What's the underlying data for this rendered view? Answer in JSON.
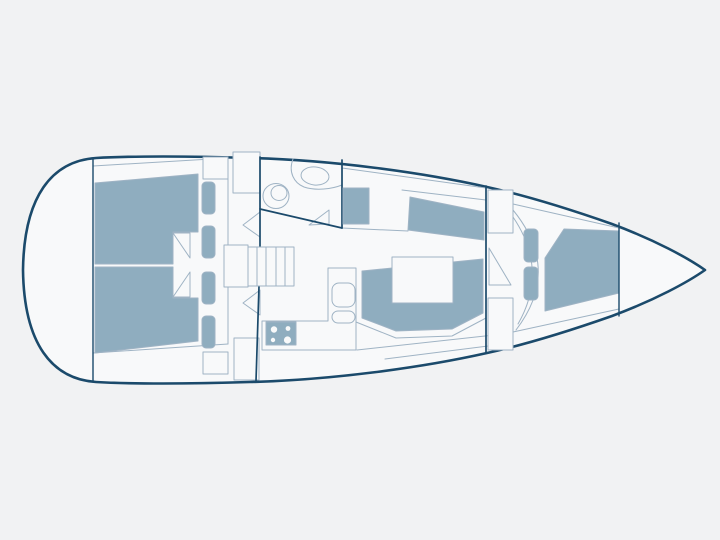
{
  "palette": {
    "bg": "#f1f2f3",
    "hullFill": "#f8f9fa",
    "navy": "#1b4a6b",
    "line": "#9fb3c4",
    "berth": "#8fadbf",
    "white": "#f8f9fa"
  },
  "canvas": {
    "width": 720,
    "height": 540
  },
  "diagram": {
    "kind": "sailboat-interior-floorplan",
    "shapes": [
      {
        "name": "hull-outline",
        "kind": "path",
        "d": "M705,270 C688,258 655,240 612,224 C575,211 528,196 487,187 C420,172 330,160 250,158 C190,156 130,156 96,158 C52,161 24,196 23,270 C24,344 52,379 96,382 C130,384 190,384 250,382 C330,380 420,368 487,353 C528,344 575,329 612,316 C655,300 688,282 705,270 Z",
        "fill": "$hullFill",
        "stroke": "$navy",
        "sw": 2.6
      },
      {
        "name": "side-deck-line-top-aft",
        "kind": "line",
        "x1": 93,
        "y1": 166,
        "x2": 228,
        "y2": 158,
        "stroke": "$line",
        "sw": 1
      },
      {
        "name": "side-deck-line-bottom-aft",
        "kind": "line",
        "x1": 93,
        "y1": 353,
        "x2": 228,
        "y2": 344,
        "stroke": "$line",
        "sw": 1
      },
      {
        "name": "side-deck-line-top-mid",
        "kind": "line",
        "x1": 342,
        "y1": 168,
        "x2": 486,
        "y2": 188,
        "stroke": "$line",
        "sw": 1
      },
      {
        "name": "settee-back-line",
        "kind": "line",
        "x1": 402,
        "y1": 190,
        "x2": 486,
        "y2": 200,
        "stroke": "$line",
        "sw": 1
      },
      {
        "name": "side-deck-line-top-fwd",
        "kind": "line",
        "x1": 513,
        "y1": 204,
        "x2": 619,
        "y2": 228,
        "stroke": "$line",
        "sw": 1
      },
      {
        "name": "side-deck-line-bottom-fwd",
        "kind": "line",
        "x1": 513,
        "y1": 332,
        "x2": 619,
        "y2": 309,
        "stroke": "$line",
        "sw": 1
      },
      {
        "name": "cockpit-taper-line-1",
        "kind": "line",
        "x1": 357,
        "y1": 350,
        "x2": 512,
        "y2": 333,
        "stroke": "$line",
        "sw": 1
      },
      {
        "name": "cockpit-taper-line-2",
        "kind": "line",
        "x1": 385,
        "y1": 359,
        "x2": 512,
        "y2": 343,
        "stroke": "$line",
        "sw": 1
      },
      {
        "name": "nav-area-base-line",
        "kind": "line",
        "x1": 342,
        "y1": 228,
        "x2": 408,
        "y2": 231,
        "stroke": "$line",
        "sw": 1
      },
      {
        "name": "aft-cabin-top-berth",
        "kind": "polygon",
        "points": "95,183 198,174 198,232 173,232 173,264 95,264",
        "fill": "$berth",
        "stroke": "$line",
        "sw": 1
      },
      {
        "name": "aft-cabin-top-door-leaf",
        "kind": "polygon",
        "points": "173,233 190,233 190,258",
        "fill": "$white",
        "stroke": "$line",
        "sw": 1
      },
      {
        "name": "aft-cabin-top-pillow-1",
        "kind": "rect",
        "x": 202,
        "y": 182,
        "w": 13,
        "h": 32,
        "rx": 4,
        "fill": "$berth",
        "stroke": "$line",
        "sw": 1
      },
      {
        "name": "aft-cabin-top-pillow-2",
        "kind": "rect",
        "x": 202,
        "y": 226,
        "w": 13,
        "h": 32,
        "rx": 4,
        "fill": "$berth",
        "stroke": "$line",
        "sw": 1
      },
      {
        "name": "aft-cabin-top-wall",
        "kind": "line",
        "x1": 228,
        "y1": 157,
        "x2": 228,
        "y2": 264,
        "stroke": "$line",
        "sw": 1
      },
      {
        "name": "aft-cabin-top-shelf",
        "kind": "rect",
        "x": 203,
        "y": 157,
        "w": 25,
        "h": 22,
        "rx": 0,
        "fill": "$white",
        "stroke": "$line",
        "sw": 1
      },
      {
        "name": "aft-cabin-bottom-berth",
        "kind": "polygon",
        "points": "95,267 173,267 173,298 198,298 198,341 95,353",
        "fill": "$berth",
        "stroke": "$line",
        "sw": 1
      },
      {
        "name": "aft-cabin-bottom-door-leaf",
        "kind": "polygon",
        "points": "173,297 190,297 190,272",
        "fill": "$white",
        "stroke": "$line",
        "sw": 1
      },
      {
        "name": "aft-cabin-bottom-pillow-1",
        "kind": "rect",
        "x": 202,
        "y": 272,
        "w": 13,
        "h": 32,
        "rx": 4,
        "fill": "$berth",
        "stroke": "$line",
        "sw": 1
      },
      {
        "name": "aft-cabin-bottom-pillow-2",
        "kind": "rect",
        "x": 202,
        "y": 316,
        "w": 13,
        "h": 32,
        "rx": 4,
        "fill": "$berth",
        "stroke": "$line",
        "sw": 1
      },
      {
        "name": "aft-cabin-bottom-wall",
        "kind": "line",
        "x1": 228,
        "y1": 267,
        "x2": 228,
        "y2": 344,
        "stroke": "$line",
        "sw": 1
      },
      {
        "name": "aft-cabin-bottom-shelf",
        "kind": "rect",
        "x": 203,
        "y": 352,
        "w": 25,
        "h": 22,
        "rx": 0,
        "fill": "$white",
        "stroke": "$line",
        "sw": 1
      },
      {
        "name": "top-locker",
        "kind": "rect",
        "x": 233,
        "y": 152,
        "w": 27,
        "h": 41,
        "rx": 0,
        "fill": "$white",
        "stroke": "$line",
        "sw": 1
      },
      {
        "name": "bottom-locker",
        "kind": "rect",
        "x": 234,
        "y": 338,
        "w": 25,
        "h": 42,
        "rx": 0,
        "fill": "$white",
        "stroke": "$line",
        "sw": 1
      },
      {
        "name": "engine-box",
        "kind": "rect",
        "x": 224,
        "y": 245,
        "w": 24,
        "h": 42,
        "rx": 0,
        "fill": "$white",
        "stroke": "$line",
        "sw": 1
      },
      {
        "name": "aft-cabin-top-door-swing",
        "kind": "polygon",
        "points": "260,212 260,237 243,225",
        "fill": "$white",
        "stroke": "$line",
        "sw": 1
      },
      {
        "name": "aft-cabin-bottom-door-swing",
        "kind": "polygon",
        "points": "260,290 260,315 243,303",
        "fill": "$white",
        "stroke": "$line",
        "sw": 1
      },
      {
        "name": "head-vanity-counter",
        "kind": "path",
        "d": "M293,159 C288,172 294,183 304,187 C316,191 332,189 342,185",
        "fill": "none",
        "stroke": "$line",
        "sw": 1
      },
      {
        "name": "head-sink",
        "kind": "ellipse",
        "cx": 315,
        "cy": 176,
        "rx": 14,
        "ry": 9,
        "rotate": 6,
        "fill": "$white",
        "stroke": "$line",
        "sw": 1
      },
      {
        "name": "head-toilet-outer",
        "kind": "ellipse",
        "cx": 276,
        "cy": 196,
        "rx": 13,
        "ry": 12.5,
        "rotate": 0,
        "fill": "$white",
        "stroke": "$line",
        "sw": 1
      },
      {
        "name": "head-toilet-inner",
        "kind": "ellipse",
        "cx": 279,
        "cy": 193,
        "rx": 8,
        "ry": 7.5,
        "rotate": 0,
        "fill": "$white",
        "stroke": "$line",
        "sw": 1
      },
      {
        "name": "head-door-leaf",
        "kind": "polygon",
        "points": "309,225 329,210 329,224",
        "fill": "$white",
        "stroke": "$line",
        "sw": 1
      },
      {
        "name": "main-bulkhead-upper",
        "kind": "line",
        "x1": 260,
        "y1": 157,
        "x2": 260,
        "y2": 247,
        "stroke": "$navy",
        "sw": 1.7
      },
      {
        "name": "main-bulkhead-lower",
        "kind": "line",
        "x1": 259,
        "y1": 286,
        "x2": 256,
        "y2": 381,
        "stroke": "$navy",
        "sw": 1.7
      },
      {
        "name": "head-wall-fwd",
        "kind": "line",
        "x1": 342,
        "y1": 160,
        "x2": 342,
        "y2": 228,
        "stroke": "$navy",
        "sw": 1.7
      },
      {
        "name": "head-wall-diagonal",
        "kind": "line",
        "x1": 260,
        "y1": 209,
        "x2": 342,
        "y2": 228,
        "stroke": "$navy",
        "sw": 1.7
      },
      {
        "name": "transom-bulkhead-wall",
        "kind": "line",
        "x1": 93,
        "y1": 159,
        "x2": 93,
        "y2": 382,
        "stroke": "$navy",
        "sw": 1.4
      },
      {
        "name": "companionway-steps",
        "kind": "rect",
        "x": 248,
        "y": 247,
        "w": 46,
        "h": 39,
        "rx": 0,
        "fill": "$white",
        "stroke": "$line",
        "sw": 1
      },
      {
        "name": "companionway-step-treads",
        "kind": "path",
        "d": "M257,247 L257,286 M266,247 L266,286 M276,247 L276,286 M285,247 L285,286",
        "fill": "none",
        "stroke": "$line",
        "sw": 1
      },
      {
        "name": "galley-counter",
        "kind": "path",
        "d": "M262,350 L262,321 L328,321 L328,268 L356,268 L356,350 Z",
        "fill": "$white",
        "stroke": "$line",
        "sw": 1
      },
      {
        "name": "galley-stove",
        "kind": "rect",
        "x": 266,
        "y": 322,
        "w": 30,
        "h": 23,
        "rx": 0,
        "fill": "$berth",
        "stroke": "$line",
        "sw": 1
      },
      {
        "name": "stove-burner-1",
        "kind": "circle",
        "cx": 274,
        "cy": 329.5,
        "r": 3.2,
        "fill": "$white",
        "stroke": "none",
        "sw": 0
      },
      {
        "name": "stove-burner-2",
        "kind": "circle",
        "cx": 288,
        "cy": 328.5,
        "r": 2.4,
        "fill": "$white",
        "stroke": "none",
        "sw": 0
      },
      {
        "name": "stove-burner-3",
        "kind": "circle",
        "cx": 273,
        "cy": 340,
        "r": 2.2,
        "fill": "$white",
        "stroke": "none",
        "sw": 0
      },
      {
        "name": "stove-burner-4",
        "kind": "circle",
        "cx": 287.5,
        "cy": 340,
        "r": 3.6,
        "fill": "$white",
        "stroke": "none",
        "sw": 0
      },
      {
        "name": "galley-sink",
        "kind": "rect",
        "x": 332,
        "y": 283,
        "w": 23,
        "h": 24,
        "rx": 7,
        "fill": "$white",
        "stroke": "$line",
        "sw": 1
      },
      {
        "name": "galley-sink-drainer",
        "kind": "rect",
        "x": 332,
        "y": 311,
        "w": 23,
        "h": 12,
        "rx": 6,
        "fill": "$white",
        "stroke": "$line",
        "sw": 1
      },
      {
        "name": "nav-seat",
        "kind": "rect",
        "x": 343,
        "y": 188,
        "w": 26,
        "h": 36,
        "rx": 0,
        "fill": "$berth",
        "stroke": "$line",
        "sw": 1
      },
      {
        "name": "salon-settee-top",
        "kind": "polygon",
        "points": "410,197 484,212 484,240 408,230",
        "fill": "$berth",
        "stroke": "$line",
        "sw": 1
      },
      {
        "name": "salon-settee-u",
        "kind": "polygon",
        "points": "362,271 453,262 483,259 483,313 452,329 396,331 362,318",
        "fill": "$berth",
        "stroke": "$line",
        "sw": 1
      },
      {
        "name": "salon-settee-trim",
        "kind": "polyline",
        "points": "356,322 396,338 452,336 486,318",
        "fill": "none",
        "stroke": "$line",
        "sw": 1
      },
      {
        "name": "salon-table",
        "kind": "rect",
        "x": 392,
        "y": 257,
        "w": 61,
        "h": 46,
        "rx": 0,
        "fill": "$white",
        "stroke": "$line",
        "sw": 1
      },
      {
        "name": "fwd-bulkhead",
        "kind": "line",
        "x1": 486,
        "y1": 186,
        "x2": 486,
        "y2": 352,
        "stroke": "$navy",
        "sw": 1.7
      },
      {
        "name": "fwd-door-swing-arc-outer",
        "kind": "path",
        "d": "M513,210 Q562,270 516,330",
        "fill": "none",
        "stroke": "$line",
        "sw": 1
      },
      {
        "name": "fwd-door-swing-arc-inner",
        "kind": "path",
        "d": "M513,217 Q549,270 518,324",
        "fill": "none",
        "stroke": "$line",
        "sw": 1
      },
      {
        "name": "fwd-door-leaf",
        "kind": "polygon",
        "points": "489,248 489,285 511,285",
        "fill": "$white",
        "stroke": "$line",
        "sw": 1
      },
      {
        "name": "fwd-locker-top",
        "kind": "rect",
        "x": 488,
        "y": 190,
        "w": 25,
        "h": 43,
        "rx": 0,
        "fill": "$white",
        "stroke": "$line",
        "sw": 1
      },
      {
        "name": "fwd-locker-bottom",
        "kind": "rect",
        "x": 488,
        "y": 298,
        "w": 25,
        "h": 52,
        "rx": 0,
        "fill": "$white",
        "stroke": "$line",
        "sw": 1
      },
      {
        "name": "vberth",
        "kind": "polygon",
        "points": "545,258 564,229 619,231 619,293 545,311",
        "fill": "$berth",
        "stroke": "$line",
        "sw": 1
      },
      {
        "name": "vberth-cushion-1",
        "kind": "rect",
        "x": 524,
        "y": 229,
        "w": 14,
        "h": 33,
        "rx": 4,
        "fill": "$berth",
        "stroke": "$line",
        "sw": 1
      },
      {
        "name": "vberth-cushion-2",
        "kind": "rect",
        "x": 524,
        "y": 267,
        "w": 14,
        "h": 33,
        "rx": 4,
        "fill": "$berth",
        "stroke": "$line",
        "sw": 1
      },
      {
        "name": "bow-locker-bulkhead",
        "kind": "line",
        "x1": 619,
        "y1": 223,
        "x2": 619,
        "y2": 316,
        "stroke": "$navy",
        "sw": 1.4
      }
    ]
  }
}
